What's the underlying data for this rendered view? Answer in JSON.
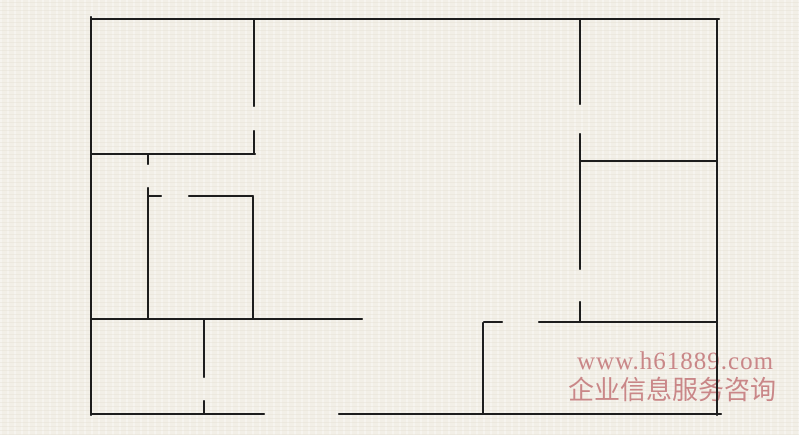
{
  "canvas": {
    "width": 799,
    "height": 435,
    "background": "#f3f0e9",
    "wall_color": "#1d1d1d",
    "wall_thickness": 2
  },
  "watermark": {
    "url": "www.h61889.com",
    "caption": "企业信息服务咨询",
    "color": "#c4797b"
  },
  "walls": [
    {
      "name": "outer-wall-top",
      "x1": 91,
      "y1": 19,
      "x2": 720,
      "y2": 19
    },
    {
      "name": "outer-wall-left",
      "x1": 91,
      "y1": 16,
      "x2": 91,
      "y2": 416
    },
    {
      "name": "outer-wall-right",
      "x1": 717,
      "y1": 19,
      "x2": 717,
      "y2": 416
    },
    {
      "name": "outer-wall-bottom-left",
      "x1": 91,
      "y1": 414,
      "x2": 265,
      "y2": 414
    },
    {
      "name": "outer-wall-bottom-right",
      "x1": 338,
      "y1": 414,
      "x2": 722,
      "y2": 414
    },
    {
      "name": "wall-v254-upper",
      "x1": 254,
      "y1": 19,
      "x2": 254,
      "y2": 107
    },
    {
      "name": "wall-v254-lower",
      "x1": 254,
      "y1": 130,
      "x2": 254,
      "y2": 155
    },
    {
      "name": "wall-h154",
      "x1": 91,
      "y1": 154,
      "x2": 256,
      "y2": 154
    },
    {
      "name": "wall-v148-stub",
      "x1": 148,
      "y1": 154,
      "x2": 148,
      "y2": 165
    },
    {
      "name": "wall-v148",
      "x1": 148,
      "y1": 187,
      "x2": 148,
      "y2": 320
    },
    {
      "name": "wall-h196-stub",
      "x1": 148,
      "y1": 196,
      "x2": 162,
      "y2": 196
    },
    {
      "name": "wall-h196",
      "x1": 188,
      "y1": 196,
      "x2": 254,
      "y2": 196
    },
    {
      "name": "wall-v253",
      "x1": 253,
      "y1": 196,
      "x2": 253,
      "y2": 320
    },
    {
      "name": "wall-h319",
      "x1": 91,
      "y1": 319,
      "x2": 363,
      "y2": 319
    },
    {
      "name": "wall-v204-upper",
      "x1": 204,
      "y1": 319,
      "x2": 204,
      "y2": 378
    },
    {
      "name": "wall-v204-lower",
      "x1": 204,
      "y1": 400,
      "x2": 204,
      "y2": 415
    },
    {
      "name": "wall-v580-upper",
      "x1": 580,
      "y1": 19,
      "x2": 580,
      "y2": 105
    },
    {
      "name": "wall-v580-middle",
      "x1": 580,
      "y1": 133,
      "x2": 580,
      "y2": 270
    },
    {
      "name": "wall-v580-lower",
      "x1": 580,
      "y1": 301,
      "x2": 580,
      "y2": 323
    },
    {
      "name": "wall-h161",
      "x1": 580,
      "y1": 161,
      "x2": 717,
      "y2": 161
    },
    {
      "name": "wall-h322-stub",
      "x1": 483,
      "y1": 322,
      "x2": 503,
      "y2": 322
    },
    {
      "name": "wall-h322",
      "x1": 538,
      "y1": 322,
      "x2": 717,
      "y2": 322
    },
    {
      "name": "wall-v483",
      "x1": 483,
      "y1": 322,
      "x2": 483,
      "y2": 415
    }
  ]
}
